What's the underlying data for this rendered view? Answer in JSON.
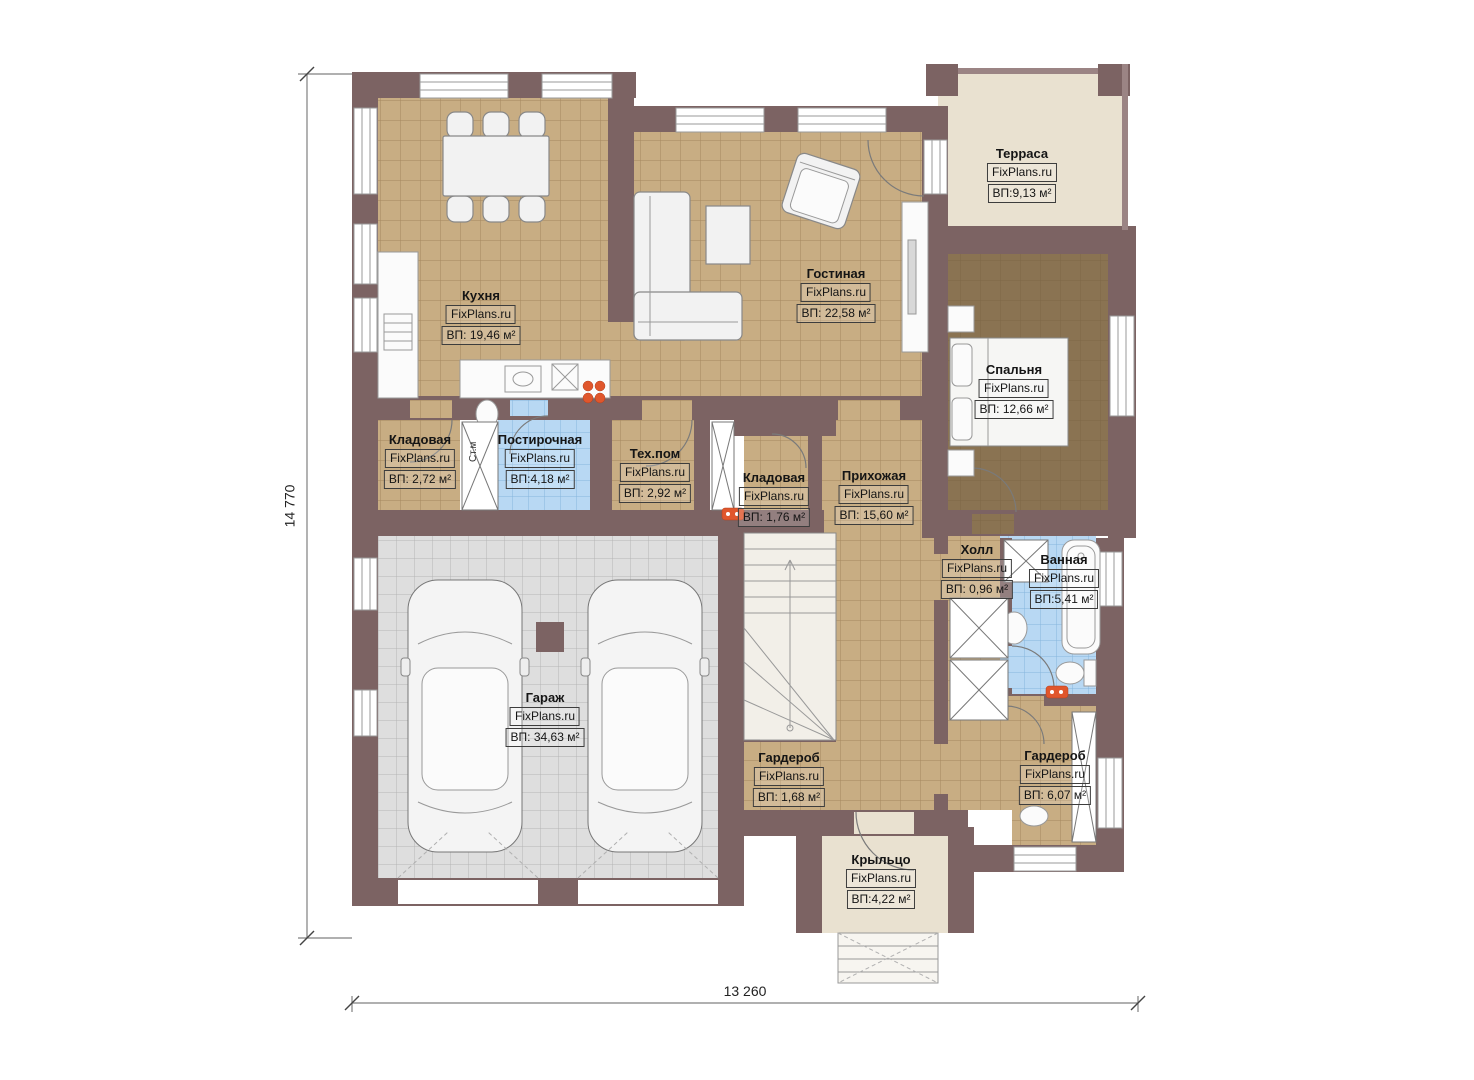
{
  "watermark": "FixPlans.ru",
  "dimensions": {
    "height": "14 770",
    "width": "13 260"
  },
  "labels": {
    "stm": "Ст.м"
  },
  "rooms": {
    "terrace": {
      "name": "Терраса",
      "area": "ВП:9,13 м²"
    },
    "kitchen": {
      "name": "Кухня",
      "area": "ВП: 19,46 м²"
    },
    "living": {
      "name": "Гостиная",
      "area": "ВП: 22,58 м²"
    },
    "bedroom": {
      "name": "Спальня",
      "area": "ВП: 12,66 м²"
    },
    "storage1": {
      "name": "Кладовая",
      "area": "ВП: 2,72 м²"
    },
    "laundry": {
      "name": "Постирочная",
      "area": "ВП:4,18 м²"
    },
    "tech": {
      "name": "Тех.пом",
      "area": "ВП: 2,92 м²"
    },
    "storage2": {
      "name": "Кладовая",
      "area": "ВП: 1,76 м²"
    },
    "hallway": {
      "name": "Прихожая",
      "area": "ВП: 15,60 м²"
    },
    "hall": {
      "name": "Холл",
      "area": "ВП: 0,96 м²"
    },
    "bathroom": {
      "name": "Ванная",
      "area": "ВП:5,41 м²"
    },
    "garage": {
      "name": "Гараж",
      "area": "ВП: 34,63 м²"
    },
    "wardrobe1": {
      "name": "Гардероб",
      "area": "ВП: 1,68 м²"
    },
    "wardrobe2": {
      "name": "Гардероб",
      "area": "ВП: 6,07 м²"
    },
    "porch": {
      "name": "Крыльцо",
      "area": "ВП:4,22 м²"
    }
  },
  "colors": {
    "wall": "#7c6363",
    "floor_tile_tan": "#c8ad83",
    "floor_tile_blue": "#b8d8f3",
    "floor_garage_gray": "#dedede",
    "floor_terrace_beige": "#e9e1d0",
    "floor_bedroom_brown": "#8a7352",
    "accent_orange": "#e0562c"
  }
}
